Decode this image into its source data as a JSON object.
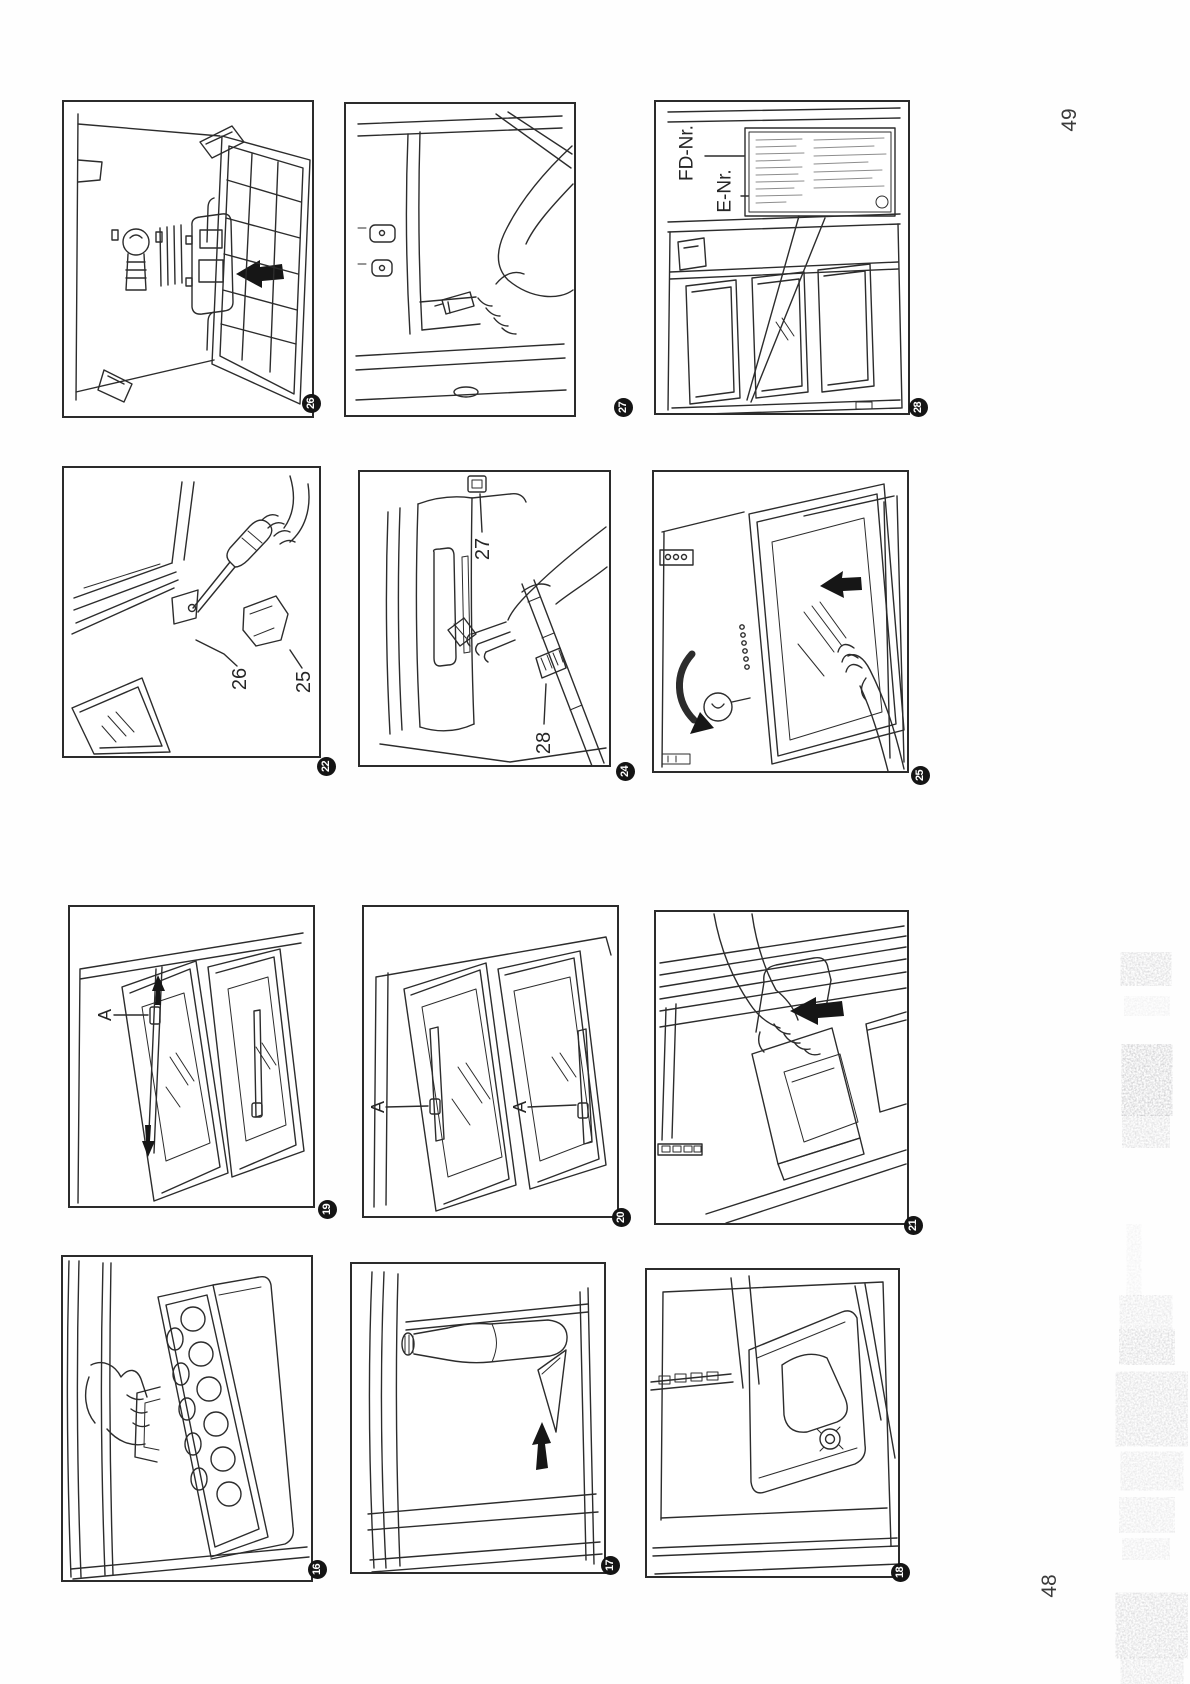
{
  "page": {
    "top_page_number": "49",
    "bottom_page_number": "48"
  },
  "figures": {
    "fig26": {
      "badge": "26"
    },
    "fig27": {
      "badge": "27"
    },
    "fig28": {
      "badge": "28",
      "label_fd": "FD-Nr.",
      "label_e": "E-Nr."
    },
    "fig22": {
      "badge": "22",
      "label_hinge": "26",
      "label_cap": "25"
    },
    "fig24": {
      "badge": "24",
      "label_pin": "27",
      "label_seal": "28"
    },
    "fig25": {
      "badge": "25"
    },
    "fig19": {
      "badge": "19",
      "label_a": "A"
    },
    "fig20": {
      "badge": "20",
      "label_a_left": "A",
      "label_a_right": "A"
    },
    "fig21": {
      "badge": "21"
    },
    "fig16": {
      "badge": "16"
    },
    "fig17": {
      "badge": "17"
    },
    "fig18": {
      "badge": "18"
    }
  },
  "colors": {
    "ink": "#2a2a2a",
    "paper": "#ffffff",
    "badge_bg": "#141414",
    "badge_text": "#ffffff"
  }
}
